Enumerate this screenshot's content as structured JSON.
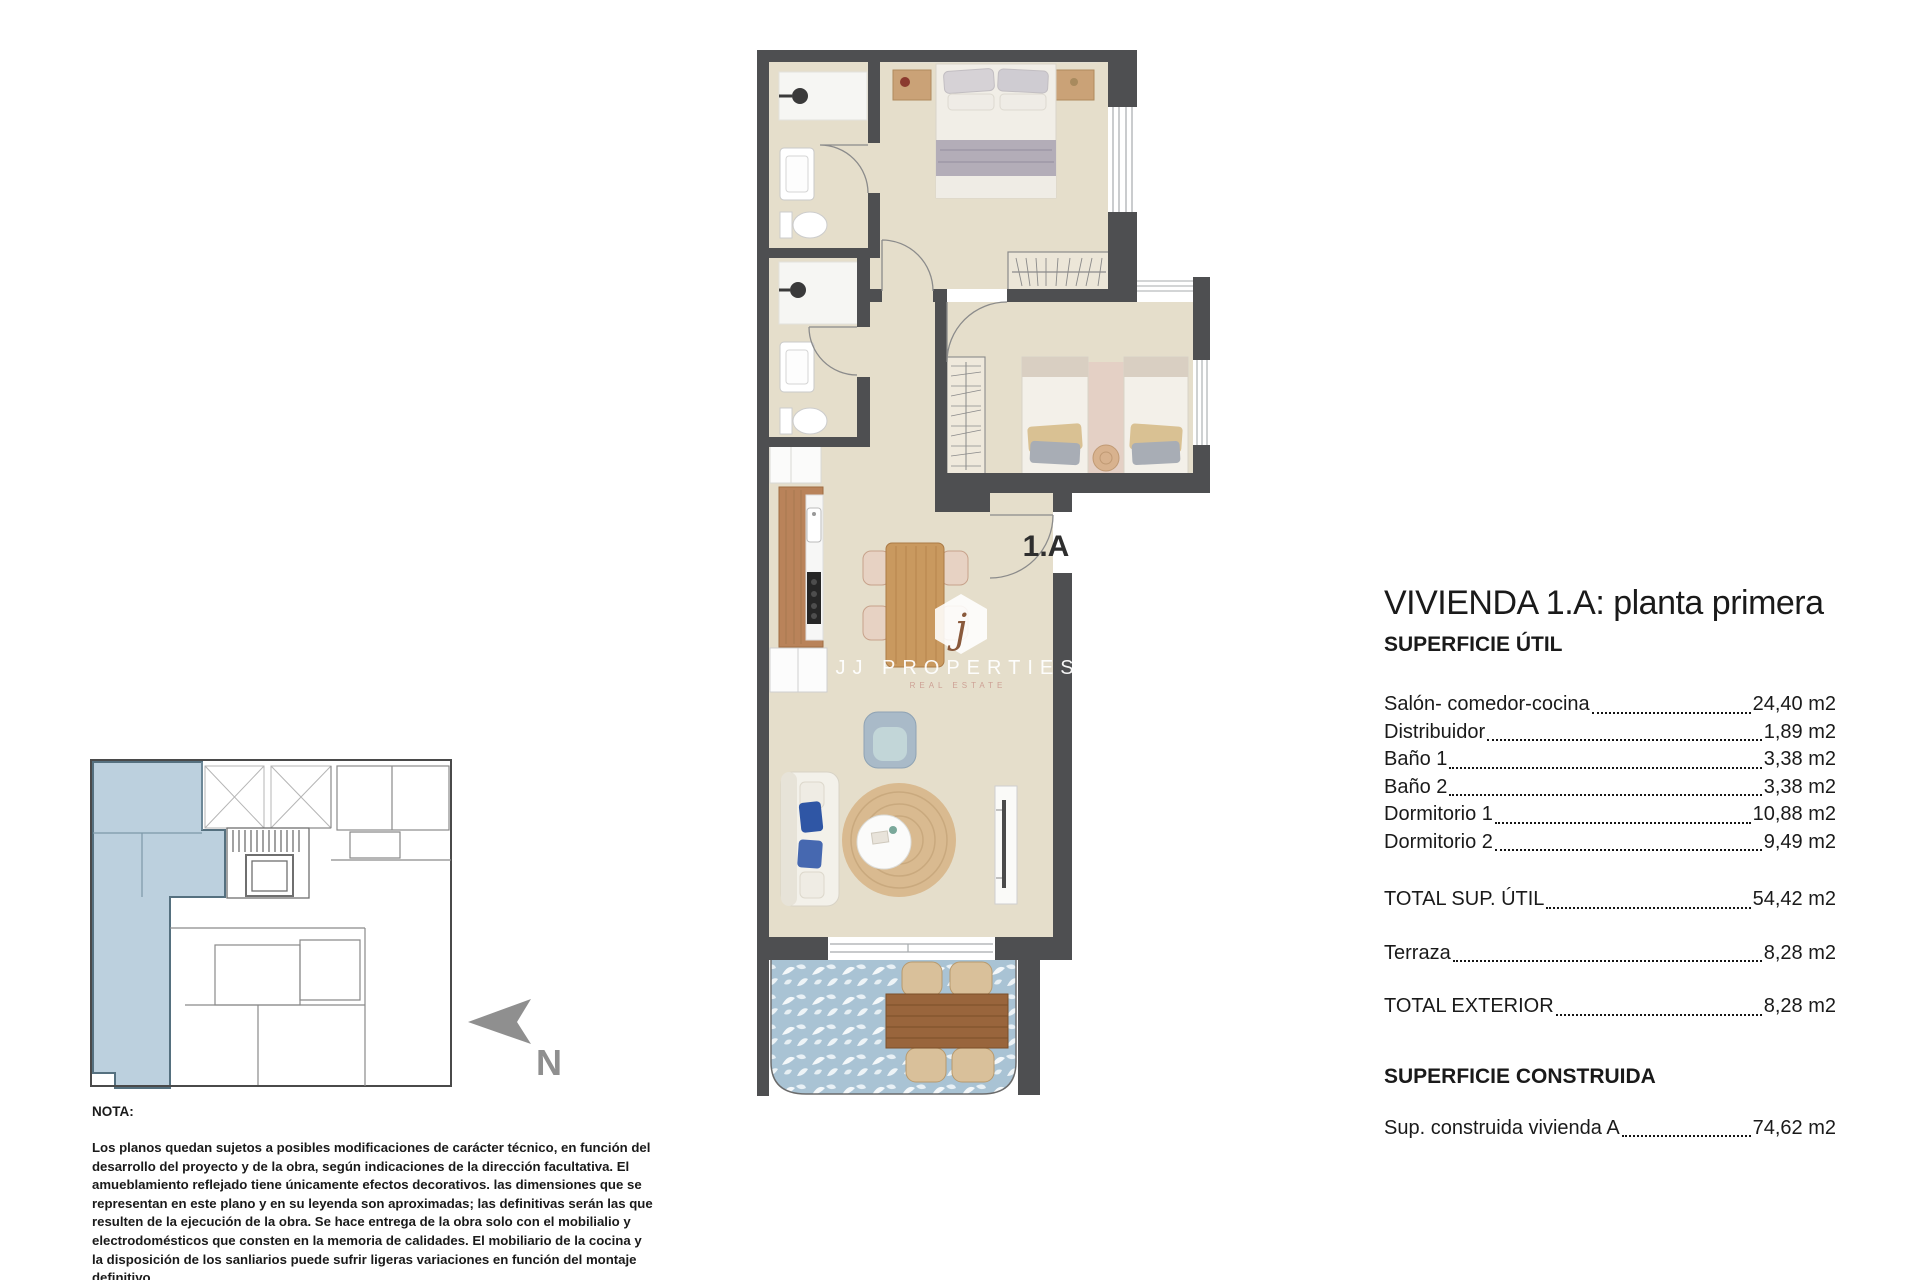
{
  "panel": {
    "title": "VIVIENDA 1.A: planta primera",
    "superficie_util_heading": "SUPERFICIE ÚTIL",
    "rooms": [
      {
        "label": "Salón- comedor-cocina",
        "value": "24,40 m2"
      },
      {
        "label": "Distribuidor",
        "value": "1,89 m2"
      },
      {
        "label": "Baño 1",
        "value": "3,38 m2"
      },
      {
        "label": "Baño 2",
        "value": "3,38 m2"
      },
      {
        "label": "Dormitorio 1",
        "value": "10,88 m2"
      },
      {
        "label": "Dormitorio 2",
        "value": "9,49 m2"
      }
    ],
    "total_util_label": "TOTAL SUP. ÚTIL",
    "total_util_value": "54,42 m2",
    "terraza_label": "Terraza",
    "terraza_value": "8,28 m2",
    "total_exterior_label": "TOTAL EXTERIOR",
    "total_exterior_value": "8,28 m2",
    "superficie_construida_heading": "SUPERFICIE CONSTRUIDA",
    "construida_label": "Sup. construida vivienda A",
    "construida_value": "74,62 m2"
  },
  "plan": {
    "unit_label": "1.A"
  },
  "watermark": {
    "logo_letter": "j",
    "name": "JJ PROPERTIES",
    "tagline": "REAL ESTATE"
  },
  "keyplan": {
    "north_label": "N"
  },
  "note": {
    "heading": "NOTA:",
    "body": "Los planos quedan sujetos a posibles modificaciones de carácter técnico, en función del desarrollo del proyecto y de la obra, según indicaciones de la dirección facultativa. El amueblamiento reflejado tiene únicamente efectos decorativos. las dimensiones que se representan en este plano y en su leyenda son aproximadas; las definitivas serán las que resulten de la ejecución de la obra. Se hace entrega de la obra solo con el mobilialio y electrodomésticos que consten en la memoria de calidades. El mobiliario de la cocina y la disposición de los sanliarios puede sufrir ligeras variaciones en función del montaje definitivo."
  },
  "colors": {
    "wall": "#4e4f51",
    "floor": "#e5decb",
    "terrace_tile": "#a9c3d4",
    "highlight": "#bcd0de",
    "wood": "#bf8a58",
    "north_arrow": "#8f8f8f"
  }
}
